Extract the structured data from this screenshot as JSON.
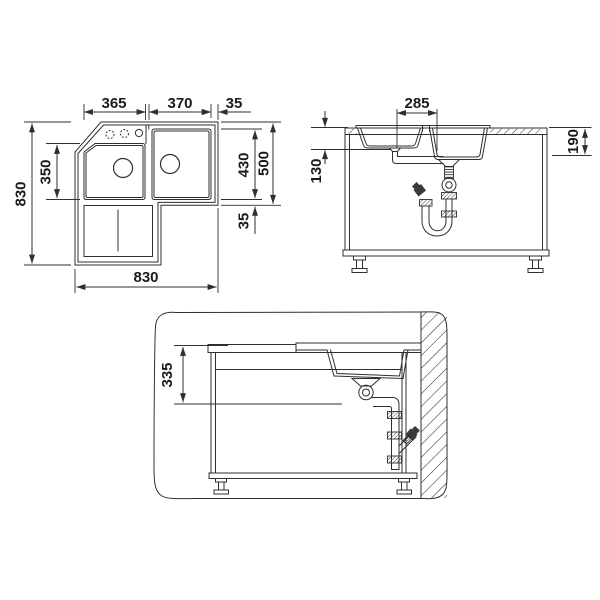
{
  "document": {
    "type": "sink-installation-technical-drawing",
    "background": "#ffffff",
    "line_color": "#2f2f2f"
  },
  "plan": {
    "dim_bowl_left_width": "365",
    "dim_bowl_right_width": "370",
    "dim_right_edge": "35",
    "dim_overall_depth": "830",
    "dim_bowl_left_depth": "350",
    "dim_bowl_right_depth": "430",
    "dim_section_depth": "500",
    "dim_bottom_edge": "35",
    "dim_overall_width": "830"
  },
  "front": {
    "dim_drain_spacing": "285",
    "dim_bowl_left_depth": "130",
    "dim_bowl_right_depth": "190"
  },
  "side": {
    "dim_drain_height": "335"
  }
}
